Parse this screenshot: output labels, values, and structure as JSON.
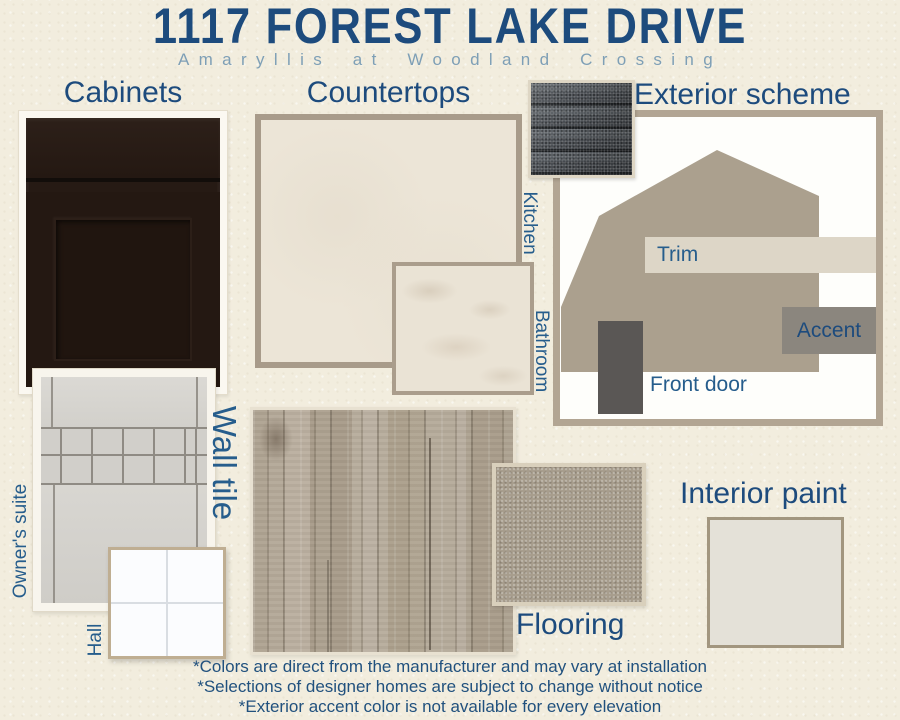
{
  "header": {
    "title": "1117 FOREST LAKE DRIVE",
    "subtitle": "Amaryllis at Woodland Crossing"
  },
  "sections": {
    "cabinets": {
      "label": "Cabinets"
    },
    "countertops": {
      "label": "Countertops",
      "kitchen": "Kitchen",
      "bathroom": "Bathroom"
    },
    "exterior": {
      "label": "Exterior scheme",
      "trim": "Trim",
      "accent": "Accent",
      "front_door": "Front door"
    },
    "wall_tile": {
      "label": "Wall tile",
      "owners_suite": "Owner's suite",
      "hall": "Hall"
    },
    "flooring": {
      "label": "Flooring"
    },
    "interior_paint": {
      "label": "Interior paint"
    }
  },
  "footnotes": [
    "*Colors are direct from the manufacturer and may vary at installation",
    "*Selections of designer homes are subject to change without notice",
    "*Exterior accent color is not available for every elevation"
  ],
  "palette": {
    "bg": "#f2edde",
    "navy": "#1d4b7d",
    "blue": "#265d8c",
    "steel": "#7e9fb6",
    "cabinet": "#261a14",
    "tile": "#d4d2cd",
    "slabBorder": "#a89b8a",
    "slab": "#ece5d7",
    "marble": "#eae3d5",
    "panelBorder": "#b2a593",
    "house": "#aba08e",
    "trim": "#ddd6c7",
    "accent": "#8b867e",
    "door": "#5a5755",
    "shingle": "#464a4f",
    "wood": "#b3a898",
    "carpet": "#a79d8d",
    "paint": "#e4e1d8"
  }
}
